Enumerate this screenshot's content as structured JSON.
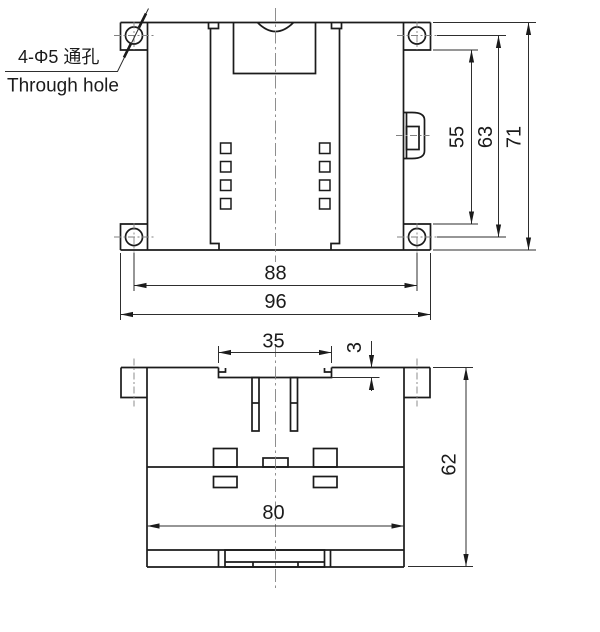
{
  "drawing": {
    "note": {
      "line1": "4-Φ5 通孔",
      "line2": "Through hole"
    },
    "front_view": {
      "height_between_tabs": "55",
      "height_hole_centers": "63",
      "height_overall": "71",
      "width_hole_centers": "88",
      "width_overall": "96"
    },
    "bottom_view": {
      "slot_width": "35",
      "step_depth": "3",
      "body_width": "80",
      "depth_overall": "62"
    }
  }
}
